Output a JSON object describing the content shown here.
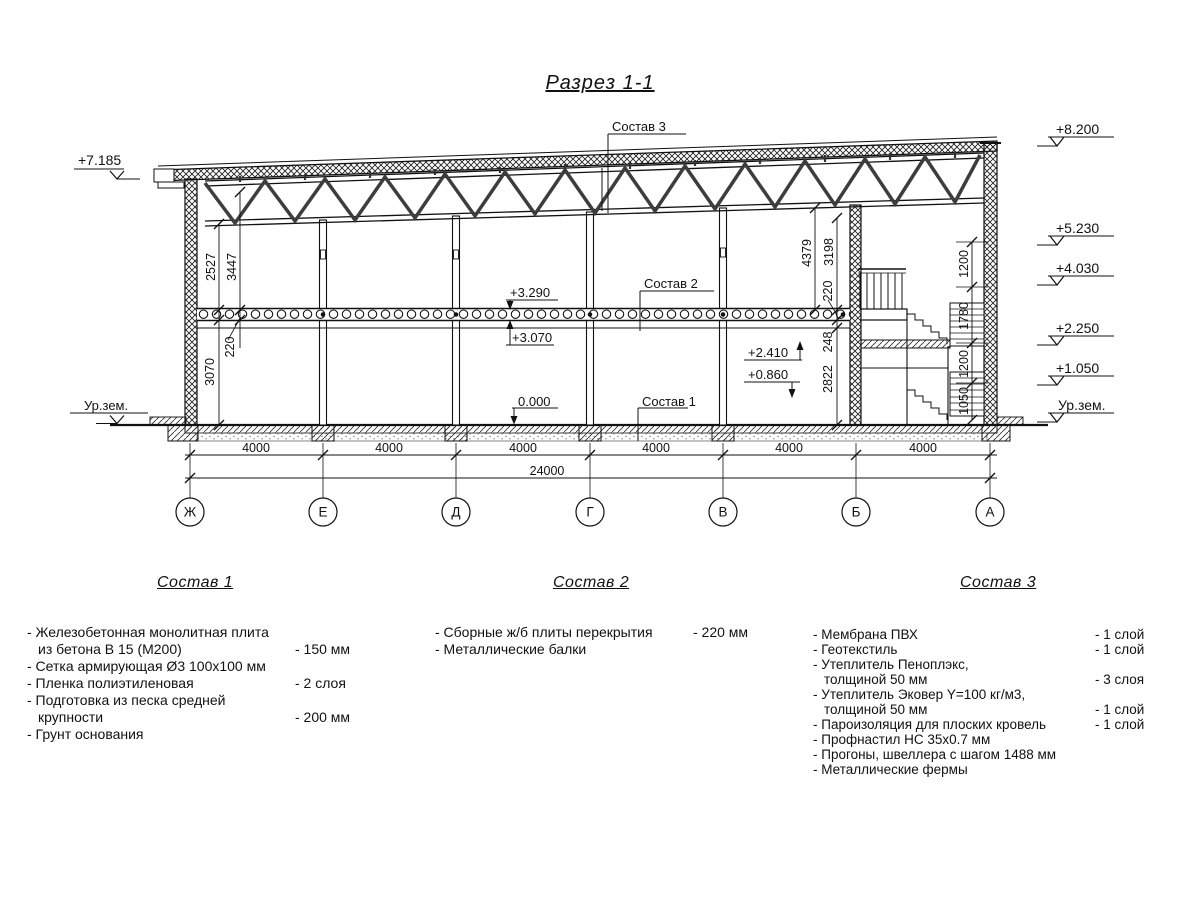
{
  "title": "Разрез 1-1",
  "leaders": {
    "s1": "Состав 1",
    "s2": "Состав 2",
    "s3": "Состав 3"
  },
  "elevations": {
    "left_roof": "+7.185",
    "ground_left": "Ур.зем.",
    "right": [
      "+8.200",
      "+5.230",
      "+4.030",
      "+2.250",
      "+1.050",
      "Ур.зем."
    ],
    "slab_top": "+3.290",
    "slab_bottom": "+3.070",
    "mezz_up": "+2.410",
    "mezz_down": "+0.860",
    "floor": "0.000"
  },
  "dimensions": {
    "left_upper": [
      "2527",
      "3447"
    ],
    "left_lower": [
      "220",
      "3070"
    ],
    "right_upper": [
      "4379",
      "3198"
    ],
    "right_lower": [
      "220",
      "248",
      "2822"
    ],
    "stair": [
      "1200",
      "1780",
      "1200",
      "1050"
    ],
    "spans": [
      "4000",
      "4000",
      "4000",
      "4000",
      "4000",
      "4000"
    ],
    "total": "24000"
  },
  "axes": [
    "Ж",
    "Е",
    "Д",
    "Г",
    "В",
    "Б",
    "А"
  ],
  "compositions": [
    {
      "title": "Состав 1",
      "items": [
        {
          "t": "- Железобетонная  монолитная плита"
        },
        {
          "t": "из бетона В 15 (М200)",
          "v": "- 150 мм"
        },
        {
          "t": "- Сетка армирующая Ø3 100х100 мм"
        },
        {
          "t": "- Пленка полиэтиленовая",
          "v": "-  2 слоя"
        },
        {
          "t": "- Подготовка из песка средней"
        },
        {
          "t": "крупности",
          "v": "- 200 мм"
        },
        {
          "t": "- Грунт основания"
        }
      ]
    },
    {
      "title": "Состав 2",
      "items": [
        {
          "t": "- Сборные ж/б плиты перекрытия",
          "v": "- 220 мм"
        },
        {
          "t": "- Металлические балки"
        }
      ]
    },
    {
      "title": "Состав 3",
      "items": [
        {
          "t": "- Мембрана ПВХ",
          "v": "- 1 слой"
        },
        {
          "t": "- Геотекстиль",
          "v": "- 1 слой"
        },
        {
          "t": "- Утеплитель Пеноплэкс,"
        },
        {
          "t": "толщиной 50 мм",
          "v": "- 3 слоя"
        },
        {
          "t": "- Утеплитель Эковер Y=100 кг/м3,"
        },
        {
          "t": "толщиной 50 мм",
          "v": "- 1 слой"
        },
        {
          "t": "- Пароизоляция для плоских кровель",
          "v": "- 1 слой"
        },
        {
          "t": "- Профнастил НС 35х0.7 мм"
        },
        {
          "t": "- Прогоны, швеллера с шагом 1488 мм"
        },
        {
          "t": "- Металлические фермы"
        }
      ]
    }
  ]
}
